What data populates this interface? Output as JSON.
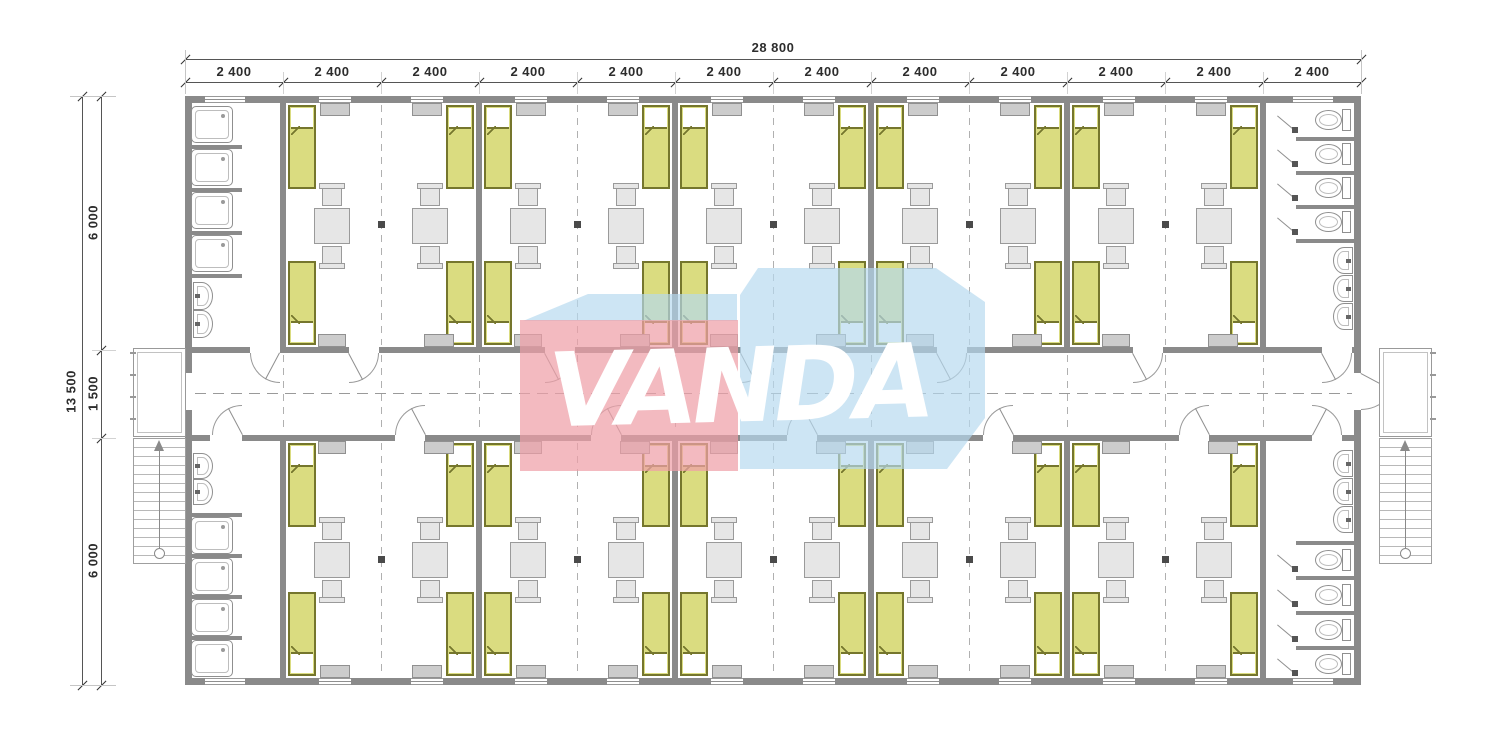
{
  "drawing": {
    "type": "architectural floor plan",
    "subject": "modular dormitory building with central corridor",
    "bays": 12,
    "rooms": [
      {
        "type": "shower-room",
        "position": "top-left",
        "showers": 4,
        "sinks": 2
      },
      {
        "type": "bedroom",
        "row": "top",
        "count": 5,
        "beds_each": 4,
        "tables_each": 2
      },
      {
        "type": "toilet-room",
        "position": "top-right",
        "toilets": 4,
        "sinks": 3
      },
      {
        "type": "shower-room",
        "position": "bottom-left",
        "showers": 4,
        "sinks": 2
      },
      {
        "type": "bedroom",
        "row": "bottom",
        "count": 5,
        "beds_each": 4,
        "tables_each": 2
      },
      {
        "type": "toilet-room",
        "position": "bottom-right",
        "toilets": 4,
        "sinks": 3
      }
    ],
    "features": [
      "central corridor",
      "entry porch left",
      "entry porch right",
      "external stair left",
      "external stair right"
    ]
  },
  "dimensions": {
    "top_total": "28 800",
    "top_bays": [
      "2 400",
      "2 400",
      "2 400",
      "2 400",
      "2 400",
      "2 400",
      "2 400",
      "2 400",
      "2 400",
      "2 400",
      "2 400",
      "2 400"
    ],
    "left_total": "13 500",
    "left_segments": [
      "6 000",
      "1 500",
      "6 000"
    ]
  },
  "watermark": {
    "text": "VANDA",
    "box_color": "#b5d9ef",
    "panel_color": "#ef9fa7",
    "text_color": "#ffffff"
  },
  "colors": {
    "wall": "#8a8a8a",
    "wall_dark": "#6f6f6f",
    "bed_fill": "#dadc80",
    "bed_border": "#75762d",
    "furniture_fill": "#e6e6e6",
    "furniture_border": "#9a9a9a",
    "cabinet_fill": "#cccccc",
    "fixture_line": "#8f8f8f",
    "dash": "#b0b0b0",
    "dim_line": "#555555",
    "dim_text": "#2d2d2d"
  }
}
